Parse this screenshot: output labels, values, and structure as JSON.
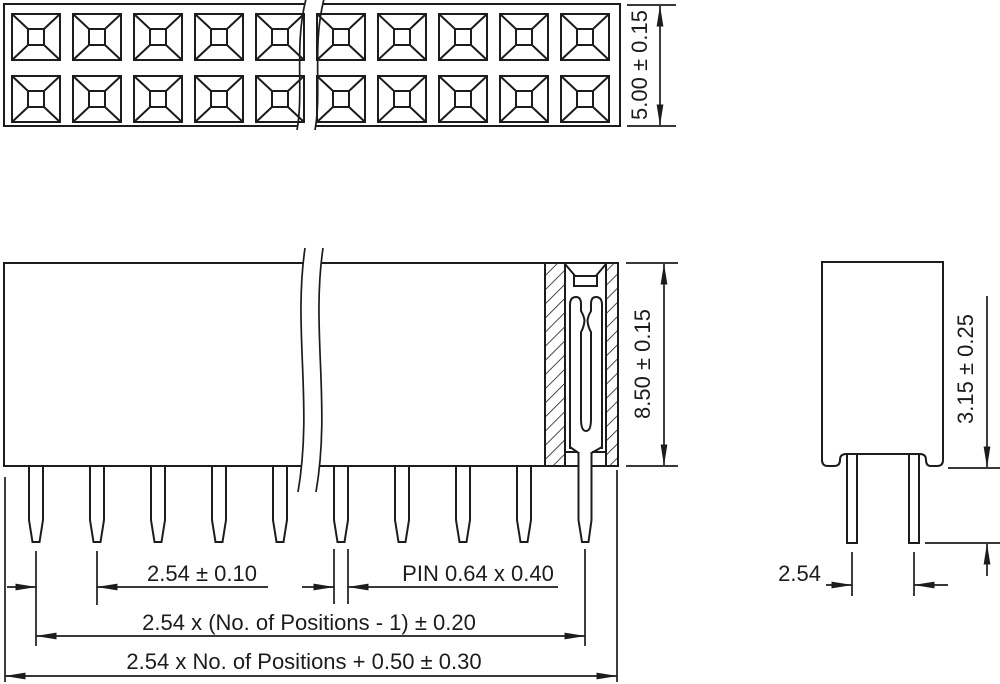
{
  "colors": {
    "line": "#1c1c1c",
    "background": "#ffffff"
  },
  "views": {
    "top": {
      "rows": 2,
      "columns": 10
    },
    "front": {
      "pins": 10
    },
    "side": {
      "pins": 2
    }
  },
  "dimensions": {
    "row_width": "5.00 ± 0.15",
    "body_height": "8.50 ± 0.15",
    "pin_protrusion": "3.15 ± 0.25",
    "row_pitch": "2.54",
    "contact_pitch": "2.54 ± 0.10",
    "pin_size": "PIN 0.64 x 0.40",
    "centers_span": "2.54 x (No. of Positions - 1) ± 0.20",
    "overall_length": "2.54 x No. of Positions + 0.50 ± 0.30"
  }
}
